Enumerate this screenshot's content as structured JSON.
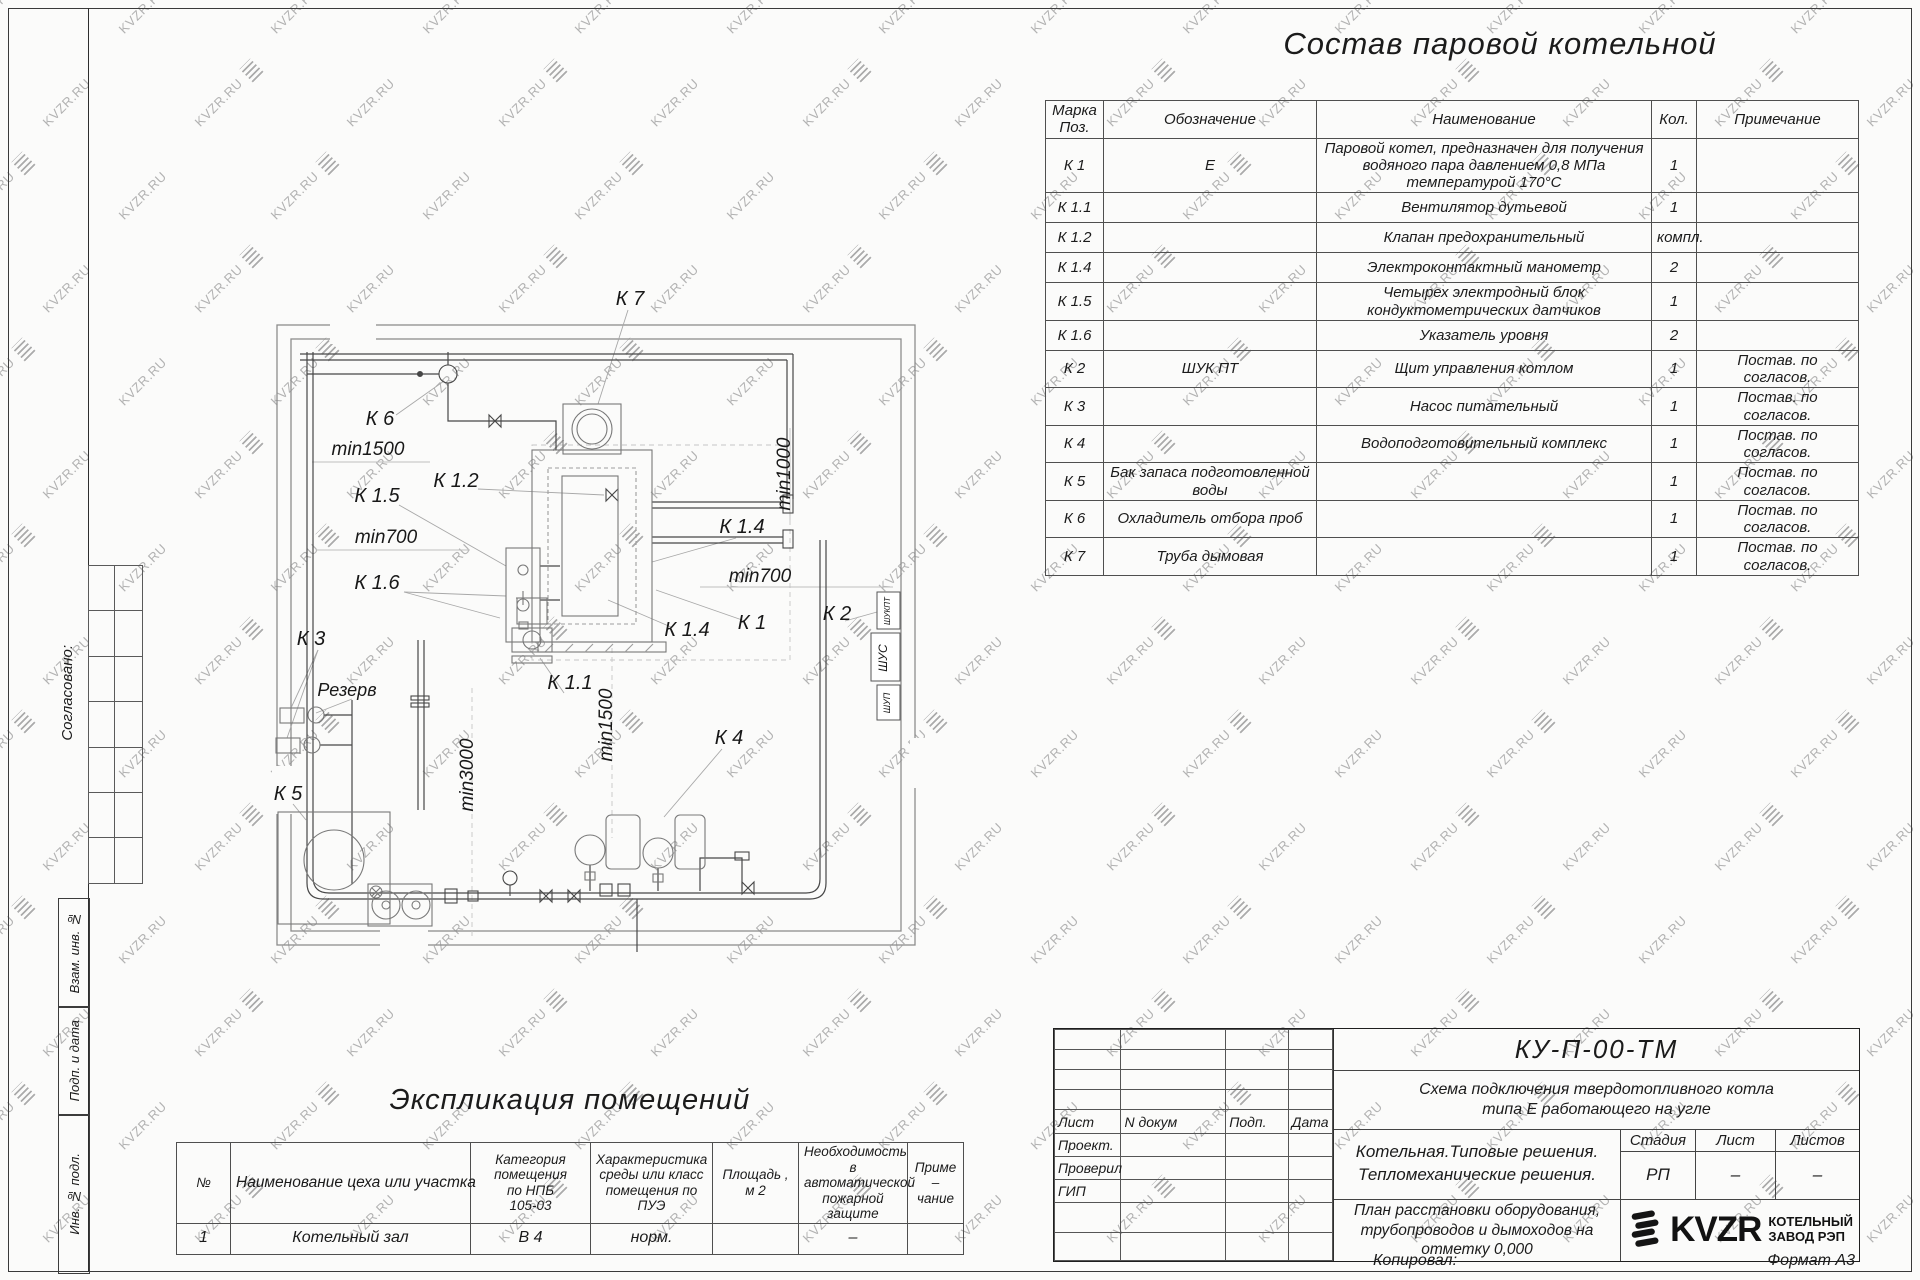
{
  "watermark": {
    "text": "KVZR.RU"
  },
  "sheet": {
    "left_margin": {
      "soglasovano": "Согласовано:",
      "vzam": "Взам. инв. №",
      "podp": "Подп. и дата",
      "inv": "Инв. № подл."
    },
    "footer": {
      "kopiroval": "Копировал:",
      "format": "Формат А3"
    }
  },
  "equipment_table": {
    "title": "Состав паровой котельной",
    "headers": [
      "Марка\nПоз.",
      "Обозначение",
      "Наименование",
      "Кол.",
      "Примечание"
    ],
    "rows": [
      {
        "mark": "К 1",
        "designation": "Е",
        "name": "Паровой котел, предназначен для получения водяного пара давлением 0,8 МПа температурой 170°С",
        "qty": "1",
        "note": ""
      },
      {
        "mark": "К 1.1",
        "designation": "",
        "name": "Вентилятор дутьевой",
        "qty": "1",
        "note": ""
      },
      {
        "mark": "К 1.2",
        "designation": "",
        "name": "Клапан предохранительный",
        "qty": "компл.",
        "note": ""
      },
      {
        "mark": "К 1.4",
        "designation": "",
        "name": "Электроконтактный манометр",
        "qty": "2",
        "note": ""
      },
      {
        "mark": "К 1.5",
        "designation": "",
        "name": "Четырех электродный блок кондуктометрических датчиков",
        "qty": "1",
        "note": ""
      },
      {
        "mark": "К 1.6",
        "designation": "",
        "name": "Указатель уровня",
        "qty": "2",
        "note": ""
      },
      {
        "mark": "К 2",
        "designation": "ШУК ПТ",
        "name": "Щит управления котлом",
        "qty": "1",
        "note": "Постав. по согласов."
      },
      {
        "mark": "К 3",
        "designation": "",
        "name": "Насос питательный",
        "qty": "1",
        "note": "Постав. по согласов."
      },
      {
        "mark": "К 4",
        "designation": "",
        "name": "Водоподготовительный комплекс",
        "qty": "1",
        "note": "Постав. по согласов."
      },
      {
        "mark": "К 5",
        "designation": "Бак запаса подготовленной воды",
        "name": "",
        "qty": "1",
        "note": "Постав. по согласов."
      },
      {
        "mark": "К 6",
        "designation": "Охладитель отбора проб",
        "name": "",
        "qty": "1",
        "note": "Постав. по согласов."
      },
      {
        "mark": "К 7",
        "designation": "Труба дымовая",
        "name": "",
        "qty": "1",
        "note": "Постав. по согласов."
      }
    ]
  },
  "rooms_table": {
    "title": "Экспликация помещений",
    "headers": [
      "№",
      "Наименование цеха или участка",
      "Категория\nпомещения\nпо НПБ\n105-03",
      "Характеристика\nсреды или класс\nпомещения по\nПУЭ",
      "Площадь ,\nм 2",
      "Необходимость в\nавтоматической\nпожарной защите",
      "Приме –\nчание"
    ],
    "rows": [
      [
        "1",
        "Котельный зал",
        "В 4",
        "норм.",
        "",
        "–",
        ""
      ]
    ]
  },
  "plan": {
    "labels": [
      {
        "t": "К 7",
        "x": 630,
        "y": 305,
        "r": 0,
        "s": 20
      },
      {
        "t": "К 6",
        "x": 380,
        "y": 425,
        "r": 0,
        "s": 20
      },
      {
        "t": "min1500",
        "x": 368,
        "y": 455,
        "r": 0,
        "s": 19
      },
      {
        "t": "К 1.2",
        "x": 456,
        "y": 487,
        "r": 0,
        "s": 20
      },
      {
        "t": "К 1.5",
        "x": 377,
        "y": 502,
        "r": 0,
        "s": 20
      },
      {
        "t": "min700",
        "x": 386,
        "y": 543,
        "r": 0,
        "s": 19
      },
      {
        "t": "К 1.6",
        "x": 377,
        "y": 589,
        "r": 0,
        "s": 20
      },
      {
        "t": "К 3",
        "x": 311,
        "y": 645,
        "r": 0,
        "s": 20
      },
      {
        "t": "Резерв",
        "x": 347,
        "y": 696,
        "r": 0,
        "s": 18
      },
      {
        "t": "К 5",
        "x": 288,
        "y": 800,
        "r": 0,
        "s": 20
      },
      {
        "t": "min3000",
        "x": 473,
        "y": 775,
        "r": -90,
        "s": 19
      },
      {
        "t": "min1500",
        "x": 612,
        "y": 725,
        "r": -90,
        "s": 19
      },
      {
        "t": "К 4",
        "x": 729,
        "y": 744,
        "r": 0,
        "s": 20
      },
      {
        "t": "К 1.1",
        "x": 570,
        "y": 689,
        "r": 0,
        "s": 20
      },
      {
        "t": "К 1.4",
        "x": 687,
        "y": 636,
        "r": 0,
        "s": 20
      },
      {
        "t": "К 1",
        "x": 752,
        "y": 629,
        "r": 0,
        "s": 20
      },
      {
        "t": "К 2",
        "x": 837,
        "y": 620,
        "r": 0,
        "s": 20
      },
      {
        "t": "min700",
        "x": 760,
        "y": 582,
        "r": 0,
        "s": 19
      },
      {
        "t": "К 1.4",
        "x": 742,
        "y": 533,
        "r": 0,
        "s": 20
      },
      {
        "t": "min1000",
        "x": 790,
        "y": 474,
        "r": -90,
        "s": 19
      }
    ],
    "cabinets": [
      {
        "t": "ШУКПТ",
        "x": 890,
        "y": 611,
        "r": -90,
        "s": 8
      },
      {
        "t": "ШУС",
        "x": 887,
        "y": 658,
        "r": -90,
        "s": 12
      },
      {
        "t": "ШУП",
        "x": 890,
        "y": 703,
        "r": -90,
        "s": 9
      }
    ]
  },
  "title_block": {
    "code": "КУ-П-00-ТМ",
    "doc_title_line1": "Схема подключения твердотопливного котла",
    "doc_title_line2": "типа Е работающего на угле",
    "org_line1": "Котельная.Типовые решения.",
    "org_line2": "Тепломеханические решения.",
    "sheet_title_line1": "План расстановки оборудования,",
    "sheet_title_line2": "трубопроводов и дымоходов на",
    "sheet_title_line3": "отметку 0,000",
    "cols": [
      "Лист",
      "N докум",
      "Подп.",
      "Дата"
    ],
    "roles": [
      "Проект.",
      "Проверил",
      "ГИП"
    ],
    "stage_label": "Стадия",
    "sheet_label": "Лист",
    "sheets_label": "Листов",
    "stage": "РП",
    "sheet": "–",
    "sheets": "–",
    "logo_text": "KVZR",
    "logo_caption_line1": "КОТЕЛЬНЫЙ",
    "logo_caption_line2": "ЗАВОД РЭП"
  }
}
